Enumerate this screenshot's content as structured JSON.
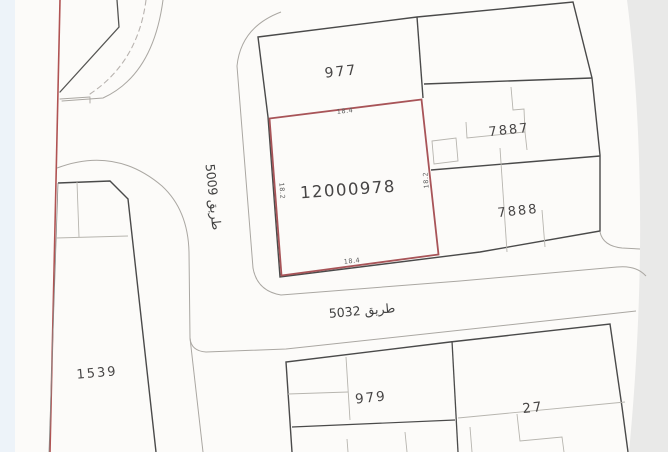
{
  "plots": {
    "p977": {
      "label": "977"
    },
    "p7887": {
      "label": "7887"
    },
    "p7888": {
      "label": "7888"
    },
    "p1539": {
      "label": "1539"
    },
    "p979": {
      "label": "979"
    },
    "p27": {
      "label": "27"
    }
  },
  "highlighted_plot": {
    "label": "12000978",
    "dimensions": {
      "top": "18.4",
      "bottom": "18.4",
      "left": "18.2",
      "right": "18.2"
    },
    "outline_color": "#a85458"
  },
  "streets": {
    "s5009": {
      "label": "طريق 5009"
    },
    "s5032": {
      "label": "طريق 5032"
    }
  },
  "colors": {
    "paper": "#fcfbf9",
    "boundary_dark": "#4a4a4a",
    "subdivision_light": "#b7b5af",
    "road_edge": "#aaa7a2",
    "cadastral_red": "#b05353",
    "highlight_red": "#a85458",
    "label_text": "#474545",
    "page_right_strip": "#e9e9e8",
    "page_left_strip": "#edf3f9"
  }
}
